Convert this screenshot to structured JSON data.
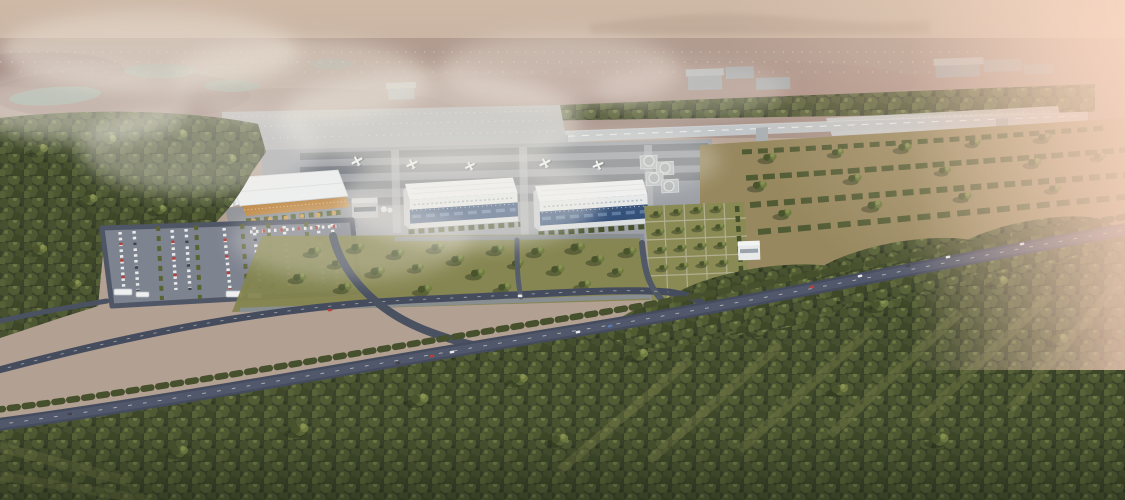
{
  "scene": {
    "kind": "aerial-architectural-rendering",
    "subject": "general aviation airport campus at hazy dawn, high oblique aerial view",
    "elements": [
      {
        "name": "sky-haze",
        "desc": "tan hazy sky fading into distant plain"
      },
      {
        "name": "distant-plain",
        "desc": "mauve and brown farmland with pale water patches and a glittering distant town"
      },
      {
        "name": "fog-clouds",
        "desc": "white fog drifting over the north-west fields and forest"
      },
      {
        "name": "distant-warehouses",
        "desc": "grey industrial boxes among trees beyond the runway"
      },
      {
        "name": "runway",
        "desc": "single runway with white centerline and threshold markings"
      },
      {
        "name": "taxiway",
        "desc": "parallel taxiway linked to the apron"
      },
      {
        "name": "west-apron",
        "desc": "concrete run-up apron with tie-down grid and amber lights"
      },
      {
        "name": "main-apron",
        "desc": "apron with dark tie-down rows and parked light aircraft"
      },
      {
        "name": "terminal-building",
        "desc": "white flat-roof terminal with angled canopy and warm glazed facade"
      },
      {
        "name": "control-tower",
        "desc": "small white tower west of the terminal"
      },
      {
        "name": "hangar-1",
        "desc": "white hangar with blue glazed front"
      },
      {
        "name": "hangar-2",
        "desc": "white hangar with blue glazed front"
      },
      {
        "name": "helipads",
        "desc": "four circular helipads east of the hangars"
      },
      {
        "name": "garden-grid",
        "desc": "formal tree grid garden east of the apron"
      },
      {
        "name": "car-parks",
        "desc": "two car parks filled with white and red cars plus shuttle buses"
      },
      {
        "name": "roads",
        "desc": "tree-lined service road and diagonal main road with light traffic"
      },
      {
        "name": "forest",
        "desc": "dense woodland with long shadows surrounding the site"
      },
      {
        "name": "pink-haze",
        "desc": "warm pink sunrise haze washing over the right edge"
      }
    ]
  },
  "colors": {
    "sky_top": "#cfbcab",
    "sky_low": "#b4a092",
    "plain": "#a8938a",
    "plain_mauve": "#8c7370",
    "water": "#8aa49d",
    "fog": "#f2ede4",
    "ridge": "#9b8574",
    "forest": "#39422a",
    "canopy_mid": "#556036",
    "canopy_light": "#76804a",
    "grass": "#8d8c58",
    "grass_warm": "#97885f",
    "grass_lane": "#7e8148",
    "runway": "#c2c6c8",
    "taxiway": "#aab0b3",
    "apron": "#9da1a7",
    "apron_dark": "#75797f",
    "west_apron": "#aeb1b4",
    "pave_sparkle": "#ccd2d3",
    "road": "#454c5e",
    "road_light": "#6e737e",
    "building_white": "#edefef",
    "building_shade": "#cdd2d4",
    "warehouse": "#a2aab0",
    "hangar_glass": "#35517a",
    "terminal_glass": "#c08b4a",
    "helipad": "#bcc0c2",
    "amber_light": "#e8a23c",
    "car_red": "#b5413a",
    "car_white": "#e9eaea",
    "car_dark": "#3e434d",
    "car_blue": "#5a7ab0",
    "bus_white": "#eef0f0",
    "pink_haze": "#f6d0be",
    "shadow": "#242d19"
  }
}
